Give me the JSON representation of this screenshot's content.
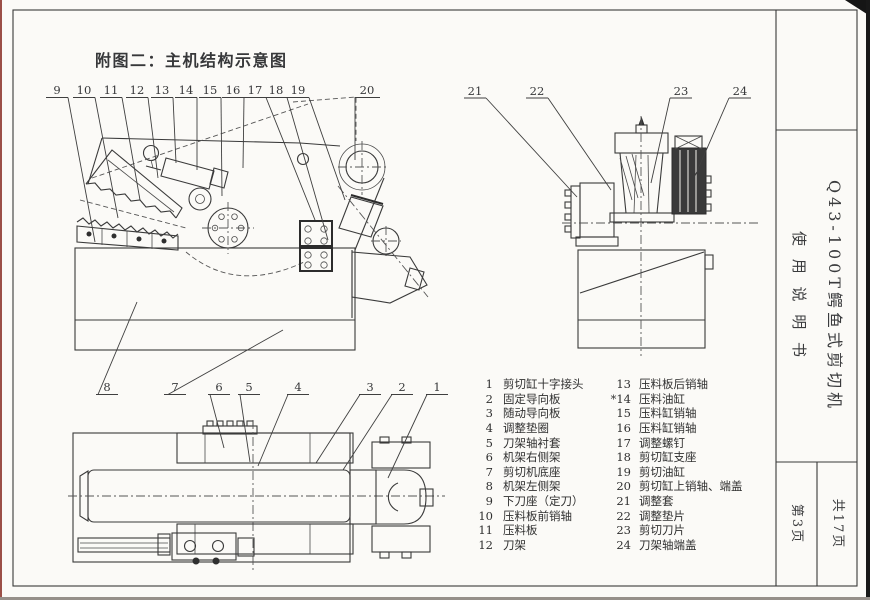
{
  "page": {
    "figure_title": "附图二：主机结构示意图"
  },
  "titleblock": {
    "machine_name": "Q43-100T鳄鱼式剪切机",
    "doc_name": "使 用 说 明 书",
    "total_pages": "共17页",
    "current_page": "第3页"
  },
  "callouts": {
    "top_left": [
      "9",
      "10",
      "11",
      "12",
      "13",
      "14",
      "15",
      "16",
      "17",
      "18",
      "19",
      "20"
    ],
    "top_right": [
      "21",
      "22",
      "23",
      "24"
    ],
    "bottom": [
      "8",
      "7",
      "6",
      "5",
      "4",
      "3",
      "2",
      "1"
    ]
  },
  "parts_list": {
    "left": [
      {
        "no": "1",
        "name": "剪切缸十字接头"
      },
      {
        "no": "2",
        "name": "固定导向板"
      },
      {
        "no": "3",
        "name": "随动导向板"
      },
      {
        "no": "4",
        "name": "调整垫圈"
      },
      {
        "no": "5",
        "name": "刀架轴衬套"
      },
      {
        "no": "6",
        "name": "机架右侧架"
      },
      {
        "no": "7",
        "name": "剪切机底座"
      },
      {
        "no": "8",
        "name": "机架左侧架"
      },
      {
        "no": "9",
        "name": "下刀座（定刀）"
      },
      {
        "no": "10",
        "name": "压料板前销轴"
      },
      {
        "no": "11",
        "name": "压料板"
      },
      {
        "no": "12",
        "name": "刀架"
      }
    ],
    "right": [
      {
        "no": "13",
        "name": "压料板后销轴"
      },
      {
        "no": "*14",
        "name": "压料油缸"
      },
      {
        "no": "15",
        "name": "压料缸销轴"
      },
      {
        "no": "16",
        "name": "压料缸销轴"
      },
      {
        "no": "17",
        "name": "调整螺钉"
      },
      {
        "no": "18",
        "name": "剪切缸支座"
      },
      {
        "no": "19",
        "name": "剪切油缸"
      },
      {
        "no": "20",
        "name": "剪切缸上销轴、端盖"
      },
      {
        "no": "21",
        "name": "调整套"
      },
      {
        "no": "22",
        "name": "调整垫片"
      },
      {
        "no": "23",
        "name": "剪切刀片"
      },
      {
        "no": "24",
        "name": "刀架轴端盖"
      }
    ]
  },
  "colors": {
    "line": "#3a3a3a",
    "paper": "#fbfaf7",
    "scan_edge": "#9b4f47"
  }
}
